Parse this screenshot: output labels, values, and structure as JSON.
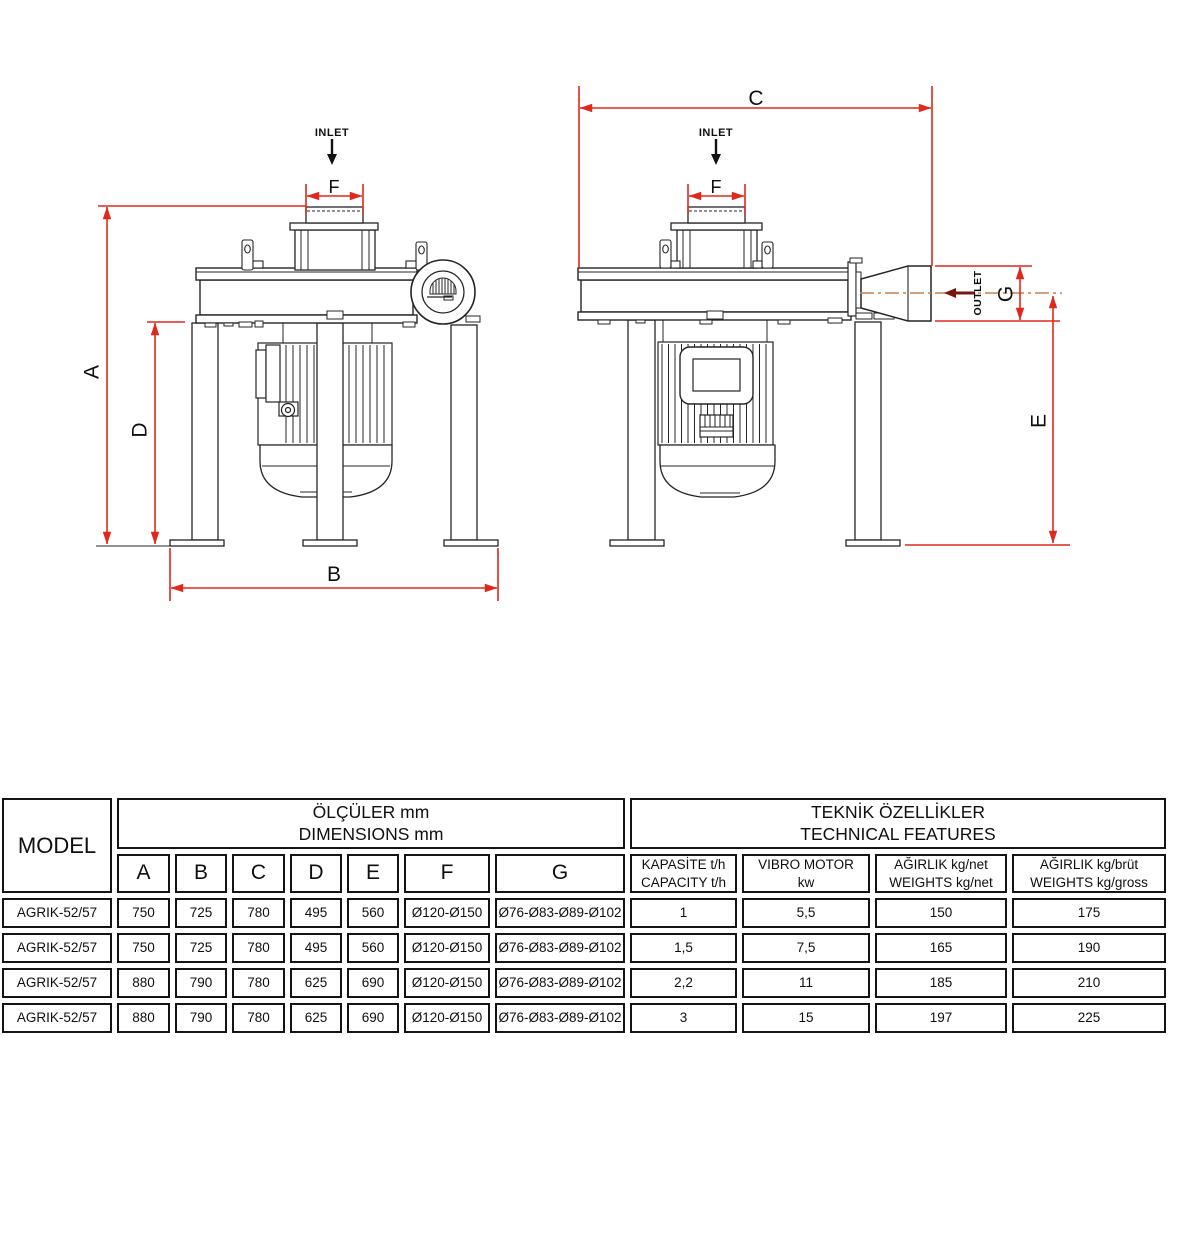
{
  "drawing": {
    "front_view": {
      "inlet": "INLET",
      "a": "A",
      "b": "B",
      "d": "D",
      "f": "F"
    },
    "side_view": {
      "inlet": "INLET",
      "outlet": "OUTLET",
      "c": "C",
      "e": "E",
      "f": "F",
      "g": "G"
    },
    "colors": {
      "dimension_red": "#e0281c",
      "centerline_orange": "#c8824e",
      "outlet_arrow_dark_red": "#77170d",
      "line_black": "#252525"
    }
  },
  "table": {
    "model_header": "MODEL",
    "dimensions_group": {
      "line1": "ÖLÇÜLER mm",
      "line2": "DIMENSIONS mm"
    },
    "features_group": {
      "line1": "TEKNİK ÖZELLİKLER",
      "line2": "TECHNICAL FEATURES"
    },
    "dim_columns": [
      "A",
      "B",
      "C",
      "D",
      "E",
      "F",
      "G"
    ],
    "feature_columns": [
      {
        "line1": "KAPASİTE t/h",
        "line2": "CAPACITY t/h"
      },
      {
        "line1": "VIBRO MOTOR",
        "line2": "kw"
      },
      {
        "line1": "AĞIRLIK kg/net",
        "line2": "WEIGHTS kg/net"
      },
      {
        "line1": "AĞIRLIK kg/brüt",
        "line2": "WEIGHTS kg/gross"
      }
    ],
    "rows": [
      [
        "AGRIK-52/57",
        "750",
        "725",
        "780",
        "495",
        "560",
        "Ø120-Ø150",
        "Ø76-Ø83-Ø89-Ø102",
        "1",
        "5,5",
        "150",
        "175"
      ],
      [
        "AGRIK-52/57",
        "750",
        "725",
        "780",
        "495",
        "560",
        "Ø120-Ø150",
        "Ø76-Ø83-Ø89-Ø102",
        "1,5",
        "7,5",
        "165",
        "190"
      ],
      [
        "AGRIK-52/57",
        "880",
        "790",
        "780",
        "625",
        "690",
        "Ø120-Ø150",
        "Ø76-Ø83-Ø89-Ø102",
        "2,2",
        "11",
        "185",
        "210"
      ],
      [
        "AGRIK-52/57",
        "880",
        "790",
        "780",
        "625",
        "690",
        "Ø120-Ø150",
        "Ø76-Ø83-Ø89-Ø102",
        "3",
        "15",
        "197",
        "225"
      ]
    ]
  }
}
